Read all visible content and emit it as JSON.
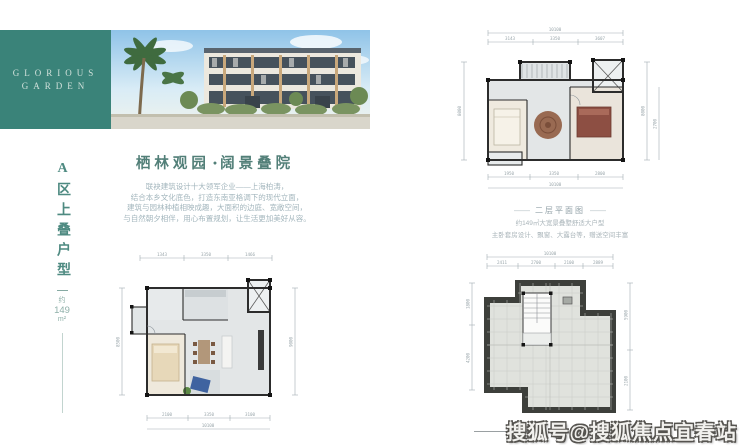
{
  "brand": {
    "name_line1": "GLORIOUS",
    "name_line2": "GARDEN"
  },
  "side_label": {
    "title": "A区上叠户型",
    "approx": "约",
    "area_value": "149",
    "area_unit": "m²"
  },
  "headline": {
    "left": "栖林观园",
    "dot": "●",
    "right": "阔景叠院"
  },
  "intro": {
    "lines": [
      "联袂建筑设计十大领军企业——上海柏涛，",
      "结合本乡文化底色，打造东南亚格调下的现代立面，",
      "建筑与园林种植相映成趣，大面积的边庭、宽敞空间，",
      "与自然朝夕相伴，用心布置规划，让生活更加美好从容。"
    ]
  },
  "plan_second_floor": {
    "caption_dash": "——",
    "caption_title": "二层平面图",
    "caption_line1": "约149㎡大宽景叠墅舒适大户型",
    "caption_line2": "主卧套房设计、飘窗、大露台等，赠送空间丰富",
    "dim_top_total": "10100",
    "dims_top": [
      "3143",
      "3350",
      "3607"
    ],
    "dims_left": [
      "8000"
    ],
    "dims_right": [
      "8000",
      "2700"
    ],
    "dims_bottom": [
      "1950",
      "3350",
      "2800"
    ],
    "dim_bottom_total": "10100"
  },
  "plan_first_floor": {
    "dims_top": [
      "1343",
      "3350",
      "1466"
    ],
    "dims_left": [
      "8500"
    ],
    "dims_right": [
      "9000"
    ],
    "dims_bottom": [
      "2100",
      "3350",
      "3100"
    ],
    "dim_bottom_total": "10100"
  },
  "plan_roof": {
    "dim_top_total": "10100",
    "dims_top": [
      "2411",
      "2700",
      "2100",
      "2889"
    ],
    "dims_left": [
      "1800",
      "4200"
    ],
    "dims_right": [
      "5900",
      "2100"
    ]
  },
  "watermark": {
    "text": "搜狐号@搜狐焦点宜春站"
  },
  "colors": {
    "brand_teal": "#3a8379",
    "headline_teal": "#527f78",
    "body_text": "#a3b6bd",
    "wall_dark": "#2c2c2c",
    "roof_wall": "#3d3f3b",
    "bed_red": "#8d4f43",
    "sofa_blue": "#3f63a0",
    "watermark_fill": "#f2f1ee"
  }
}
